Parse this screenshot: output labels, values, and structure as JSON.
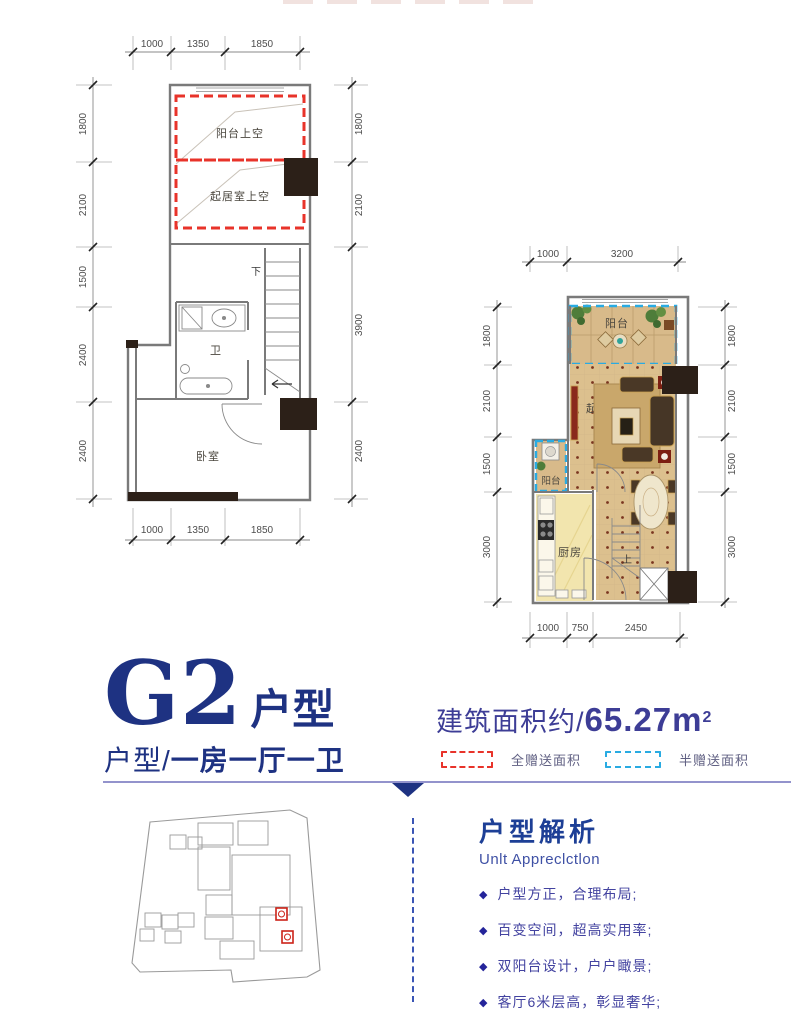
{
  "colors": {
    "accent_blue": "#1e3282",
    "area_text_blue": "#3d3d96",
    "analysis_title_blue": "#1d3f96",
    "analysis_sub_blue": "#3f51a5",
    "bullet_text_blue": "#4343a0",
    "red_dash": "#e8332a",
    "cyan_dash": "#29abe2",
    "wall_gray": "#7a7a7a",
    "dim_gray": "#4d4d4d",
    "floor_tan": "#dcc08e",
    "rug_tan": "#c9a76b",
    "kitchen_floor": "#f2e5ae",
    "black_block": "#2c2018",
    "rule_purple": "#9393cc",
    "site_red": "#cc2218"
  },
  "plans": {
    "upper": {
      "rooms": {
        "balcony_void": "阳台上空",
        "living_void": "起居室上空",
        "bath": "卫",
        "bedroom": "卧室",
        "stairs_down": "下"
      },
      "dims": {
        "top": [
          "1000",
          "1350",
          "1850"
        ],
        "bottom": [
          "1000",
          "1350",
          "1850"
        ],
        "left": [
          "1800",
          "2100",
          "1500",
          "2400",
          "2400"
        ],
        "right": [
          "1800",
          "2100",
          "3900",
          "2400"
        ]
      }
    },
    "lower": {
      "rooms": {
        "balcony": "阳台",
        "living": "起居室",
        "side_balcony": "阳台",
        "kitchen": "厨房",
        "stairs_up": "上"
      },
      "dims": {
        "top": [
          "1000",
          "3200"
        ],
        "bottom": [
          "1000",
          "750",
          "2450"
        ],
        "left": [
          "1800",
          "2100",
          "1500",
          "3000"
        ],
        "right": [
          "1800",
          "2100",
          "1500",
          "3000"
        ]
      }
    }
  },
  "title": {
    "code": "G2",
    "suffix": "户型",
    "layout_prefix": "户型/",
    "layout": "一房一厅一卫"
  },
  "area": {
    "label": "建筑面积约/",
    "value": "65.27m",
    "sup": "2"
  },
  "legend": {
    "full": "全赠送面积",
    "half": "半赠送面积"
  },
  "analysis": {
    "title": "户型解析",
    "subtitle": "Unlt Appreclctlon",
    "bullet_icon": "◆",
    "bullets": [
      "户型方正，合理布局;",
      "百变空间，超高实用率;",
      "双阳台设计，户户瞰景;",
      "客厅6米层高，彰显奢华;"
    ]
  }
}
